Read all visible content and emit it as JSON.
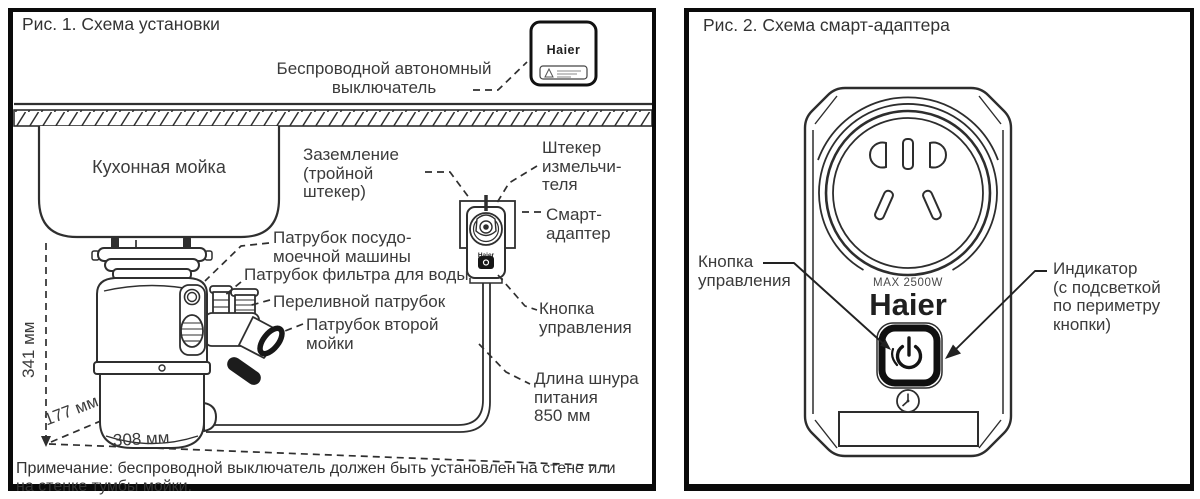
{
  "colors": {
    "ink": "#2f2f2f",
    "text": "#3b3b3b",
    "black": "#111111",
    "background": "#ffffff"
  },
  "icons": {
    "power-button-icon": "⏻",
    "clock-icon": "🕘",
    "warning-icon": "⚠"
  },
  "panel1": {
    "title": "Рис. 1. Схема установки",
    "sink": "Кухонная мойка",
    "switch_logo": "Haier",
    "adapter_logo": "Haier",
    "labels": {
      "wireless_switch": "Беспроводной автономный\nвыключатель",
      "grounding": "Заземление\n(тройной\nштекер)",
      "dishwasher_pipe": "Патрубок посудо-\nмоечной машины",
      "water_filter_pipe": "Патрубок фильтра для воды",
      "overflow_pipe": "Переливной патрубок",
      "second_sink_pipe": "Патрубок второй\nмойки",
      "grinder_plug": "Штекер\nизмельчи-\nтеля",
      "smart_adapter": "Смарт-\nадаптер",
      "control_button": "Кнопка\nуправления",
      "cord_length": "Длина шнура\nпитания\n850 мм"
    },
    "dimensions": {
      "height": "341 мм",
      "depth": "177 мм",
      "width": "308 мм"
    },
    "note": "Примечание: беспроводной выключатель должен быть установлен на стене или\nна стенке тумбы мойки."
  },
  "panel2": {
    "title": "Рис. 2. Схема смарт-адаптера",
    "logo": "Haier",
    "max_power": "MAX 2500W",
    "labels": {
      "control_button": "Кнопка\nуправления",
      "indicator": "Индикатор\n(с подсветкой\nпо периметру\nкнопки)"
    }
  }
}
